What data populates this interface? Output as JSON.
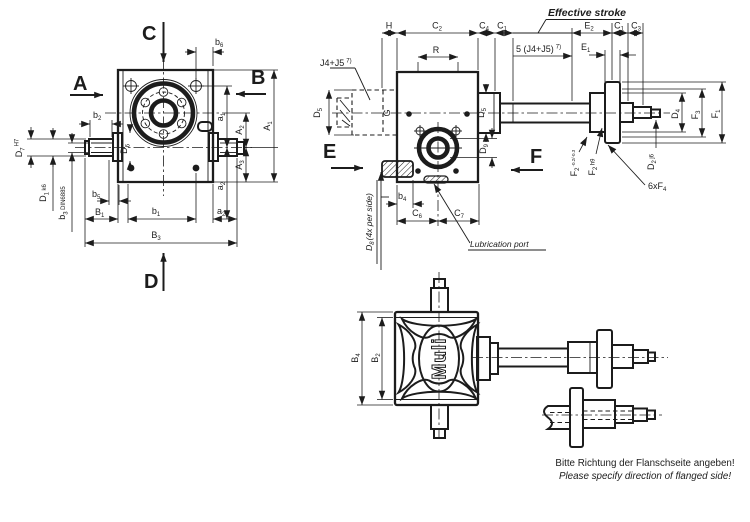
{
  "colors": {
    "line": "#1c1c1c",
    "background": "#ffffff"
  },
  "front_view": {
    "letter_a": "A",
    "letter_b": "B",
    "letter_c": "C",
    "letter_d": "D",
    "dims": {
      "b6": {
        "base": "b",
        "sub": "6"
      },
      "b2": {
        "base": "b",
        "sub": "2"
      },
      "d7": {
        "base": "D",
        "sub": "7",
        "tol": "H7"
      },
      "d1": {
        "base": "D",
        "sub": "1",
        "tol": "k6"
      },
      "b3": {
        "base": "b",
        "sub": "3",
        "tol": "DIN6885"
      },
      "d6": {
        "base": "D",
        "sub": "6"
      },
      "b5": {
        "base": "b",
        "sub": "5"
      },
      "B1": {
        "base": "B",
        "sub": "1"
      },
      "b1": {
        "base": "b",
        "sub": "1"
      },
      "a2_bottom": {
        "base": "a",
        "sub": "2"
      },
      "B3": {
        "base": "B",
        "sub": "3"
      },
      "a1": {
        "base": "a",
        "sub": "1"
      },
      "A2": {
        "base": "A",
        "sub": "2"
      },
      "A1": {
        "base": "A",
        "sub": "1"
      },
      "A3": {
        "base": "A",
        "sub": "3"
      },
      "a2_side": {
        "base": "a",
        "sub": "2"
      }
    }
  },
  "side_view": {
    "letter_e": "E",
    "letter_f": "F",
    "effective_stroke": "Effective stroke",
    "stroke_label": {
      "text": "5 (J4+J5)",
      "sup": "7)"
    },
    "screw_label": {
      "text": "J4+J5",
      "sup": "7)"
    },
    "lubrication": "Lubrication port",
    "holes_note": {
      "base": "D",
      "sub": "8",
      "rest": "(4x per side)"
    },
    "dims": {
      "H": {
        "base": "H"
      },
      "C2": {
        "base": "C",
        "sub": "2"
      },
      "C4": {
        "base": "C",
        "sub": "4"
      },
      "C1_top": {
        "base": "C",
        "sub": "1"
      },
      "E2": {
        "base": "E",
        "sub": "2"
      },
      "C1_right": {
        "base": "C",
        "sub": "1"
      },
      "C3": {
        "base": "C",
        "sub": "3"
      },
      "E1": {
        "base": "E",
        "sub": "1"
      },
      "R": {
        "base": "R"
      },
      "G": {
        "base": "G"
      },
      "D5_left": {
        "base": "D",
        "sub": "5"
      },
      "D5_right": {
        "base": "D",
        "sub": "5"
      },
      "D9": {
        "base": "D",
        "sub": "9"
      },
      "b4": {
        "base": "b",
        "sub": "4"
      },
      "C6": {
        "base": "C",
        "sub": "6"
      },
      "C7": {
        "base": "C",
        "sub": "7"
      },
      "F2_tol": {
        "base": "F",
        "sub": "2",
        "tol": "-0.2/-0.3"
      },
      "F2_h9": {
        "base": "F",
        "sub": "2",
        "tol": "h9"
      },
      "D4": {
        "base": "D",
        "sub": "4"
      },
      "F3": {
        "base": "F",
        "sub": "3"
      },
      "F1": {
        "base": "F",
        "sub": "1"
      },
      "D2": {
        "base": "D",
        "sub": "2",
        "tol": "j6"
      },
      "F4_count": {
        "pre": "6xF",
        "sub": "4"
      }
    }
  },
  "bottom_view": {
    "logo": "Muli",
    "dims": {
      "B4": {
        "base": "B",
        "sub": "4"
      },
      "B2": {
        "base": "B",
        "sub": "2"
      }
    }
  },
  "footer": {
    "note_de": "Bitte Richtung der Flanschseite angeben!",
    "note_en": "Please specify direction of flanged side!"
  }
}
